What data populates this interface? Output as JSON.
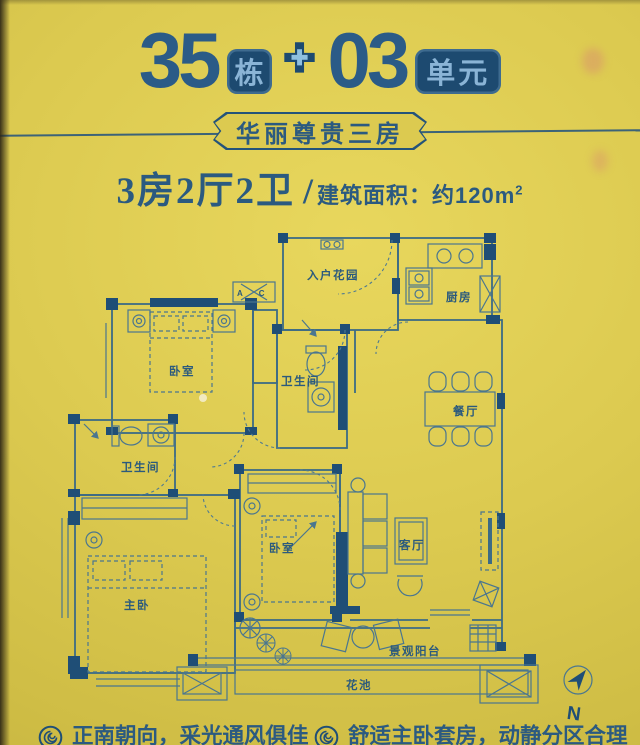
{
  "header": {
    "building_number": "35",
    "building_badge": "栋",
    "plus": "✚",
    "unit_number": "03",
    "unit_badge": "单元"
  },
  "subtitle": {
    "text": "华丽尊贵三房"
  },
  "spec": {
    "layout": "3房2厅2卫",
    "slash": "/",
    "area_prefix": "建筑面积：约120m",
    "area_sup": "2"
  },
  "floorplan": {
    "rooms": {
      "entry_garden": "入户花园",
      "kitchen": "厨房",
      "bedroom1": "卧室",
      "bath1": "卫生间",
      "dining": "餐厅",
      "bath2": "卫生间",
      "master": "主卧",
      "bedroom2": "卧室",
      "living": "客厅",
      "balcony": "景观阳台",
      "flower_bed": "花池"
    },
    "ac_label": "AC",
    "compass_label": "N"
  },
  "footnotes": {
    "left": "正南朝向，采光通风俱佳",
    "right": "舒适主卧套房，动静分区合理"
  },
  "colors": {
    "background": "#dcca50",
    "ink_navy": "#1f4e76",
    "title_blue": "#2b5b87",
    "line_teal": "#3c6b85",
    "badge_text": "#8ab4d6"
  }
}
